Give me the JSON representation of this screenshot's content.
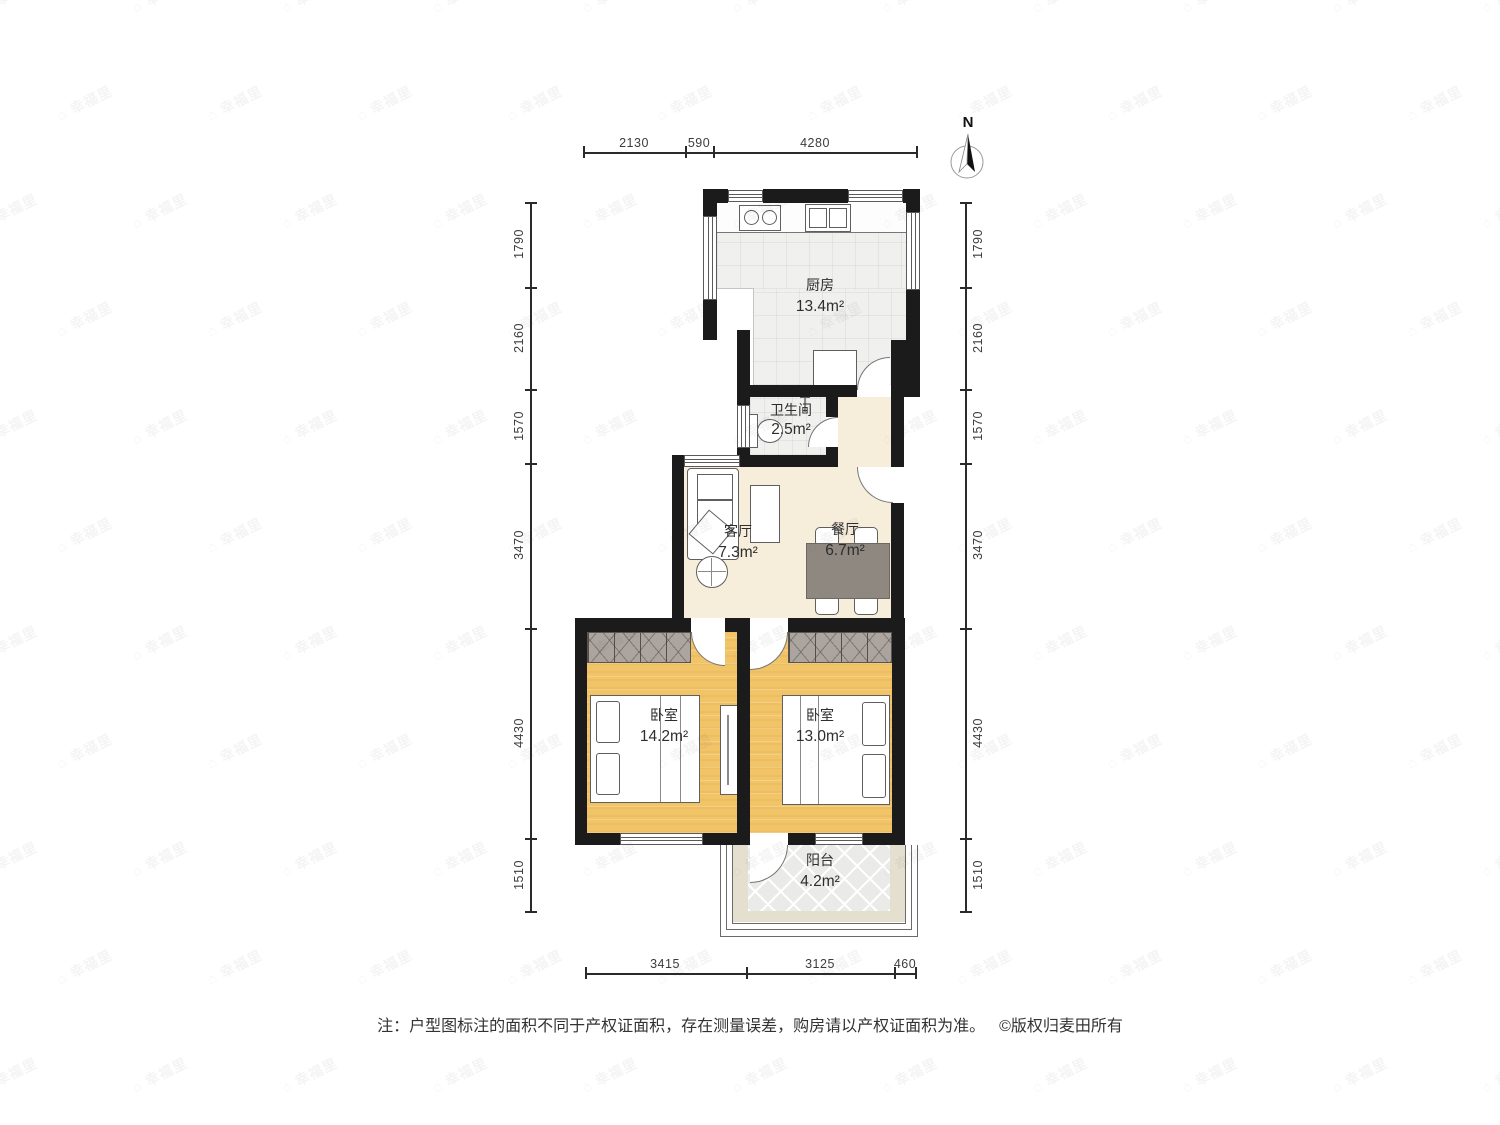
{
  "compass": {
    "label": "N"
  },
  "watermark": {
    "text": "幸福里",
    "icon": "house-icon"
  },
  "rooms": {
    "kitchen": {
      "name": "厨房",
      "area": "13.4m²"
    },
    "bathroom": {
      "name": "卫生间",
      "area": "2.5m²"
    },
    "living": {
      "name": "客厅",
      "area": "7.3m²"
    },
    "dining": {
      "name": "餐厅",
      "area": "6.7m²"
    },
    "bedroom_left": {
      "name": "卧室",
      "area": "14.2m²"
    },
    "bedroom_right": {
      "name": "卧室",
      "area": "13.0m²"
    },
    "balcony": {
      "name": "阳台",
      "area": "4.2m²"
    }
  },
  "dimensions": {
    "top": [
      "2130",
      "590",
      "4280"
    ],
    "left": [
      "1790",
      "2160",
      "1570",
      "3470",
      "4430",
      "1510"
    ],
    "right": [
      "1790",
      "2160",
      "1570",
      "3470",
      "4430",
      "1510"
    ],
    "bottom": [
      "3415",
      "3125",
      "460"
    ]
  },
  "footer": {
    "note": "注：户型图标注的面积不同于产权证面积，存在测量误差，购房请以产权证面积为准。",
    "copyright": "©版权归麦田所有"
  },
  "colors": {
    "wall": "#1b1b1b",
    "bedroom_floor": "#F2C468",
    "living_floor": "#F6EDDB",
    "tile_floor": "#F0F0EE",
    "wardrobe": "#ACA49E",
    "dining_table": "#8F8881"
  }
}
